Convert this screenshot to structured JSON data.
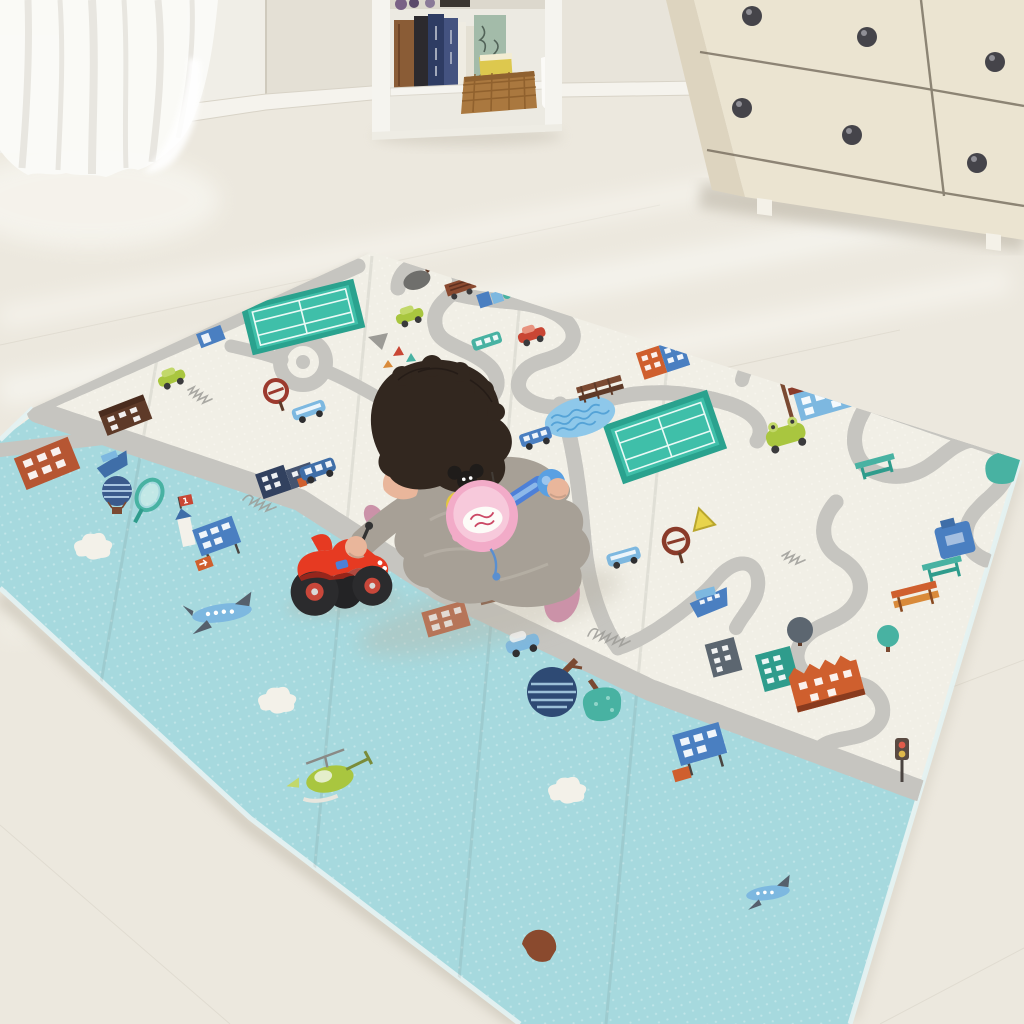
{
  "meta": {
    "description": "Lifestyle photo: baby in gray fleece onesie sits on a large foldable two-sided play mat (cream city-road side and light-blue sky side), playing with a red toy truck and a pink toy saucepan, in a bright nursery with sheer curtain, white bookshelf and cream dresser.",
    "setting": "nursery room, bright daylight"
  },
  "colors": {
    "wall": "#e8e4da",
    "wallBright": "#f0eee7",
    "wallDark": "#e4e0d5",
    "baseboard": "#f5f3ed",
    "floor": "#ece8de",
    "floorLight": "#fbfaf5",
    "shadow": "#b7b0a1",
    "curtain": "#fafaf7",
    "curtainFold": "#e4e2db",
    "shelf": "#f5f4ef",
    "shelfInner": "#eceae2",
    "shelfShade": "#dcd8cd",
    "bookBrown": "#8a5c36",
    "bookDark": "#2c2a2e",
    "bookNavy": "#2e3c63",
    "bookNavy2": "#445380",
    "bookWhite": "#efece2",
    "boxGreen": "#a3bba9",
    "boxPrint": "#44544a",
    "basket": "#aa783f",
    "basketDark": "#8a5c2a",
    "basketItem": "#ddc84e",
    "dresser": "#ebe4d1",
    "dresserSide": "#ddd4bf",
    "dresserLine": "#6d6455",
    "knob": "#45444a",
    "knobHi": "#908f96",
    "matWhite": "#f1efe6",
    "matDot": "#faf8f1",
    "matBlue": "#a6d9de",
    "matBlueDot": "#c4e7ea",
    "matEdgeFace": "#e4f1f1",
    "road": "#c6c5c0",
    "roadDash": "#ffffff",
    "courtTeal": "#3fbfa9",
    "courtTealDark": "#2aa28e",
    "courtLine": "#eafaf6",
    "pond": "#8ec8ea",
    "pondWave": "#4f9fd6",
    "navy": "#32415f",
    "slate": "#5c6670",
    "brown": "#7b4a32",
    "darkBrown": "#5e3a28",
    "rust": "#b65633",
    "orange": "#d98a3a",
    "orangeDeep": "#cf5f2e",
    "teal": "#48b2a2",
    "tealDeep": "#2f9c8c",
    "blue": "#4a7fc1",
    "skyBlue": "#7db8e0",
    "steel": "#3f6ea8",
    "red": "#c94634",
    "yellow": "#e8d44c",
    "green": "#a9c63f",
    "grayIcon": "#9c9b96",
    "white": "#ffffff",
    "babyHair": "#32271f",
    "babySkin": "#e9b69b",
    "suit": "#a7a096",
    "suitLight": "#bdb7ac",
    "pants": "#918a80",
    "sock": "#cb92a8",
    "truckRed": "#e63a22",
    "truckDark": "#b22618",
    "wheel": "#2b2b2d",
    "hub": "#c8473a",
    "hubHi": "#d9d9d9",
    "panPink": "#f2abc8",
    "panPinkLight": "#f7c9db",
    "panLabel": "#fdfcf8",
    "panRed": "#cc4a66",
    "handleBlue": "#4d80d8",
    "handleBall": "#5aa0e2",
    "handleHi": "#9cc6ee"
  },
  "room": {
    "curtain": {
      "type": "sheer white curtain",
      "position": "top-left"
    },
    "bookshelf": {
      "type": "white open bookcase",
      "contents": [
        "brown book",
        "dark book",
        "navy books with white spine text",
        "white book",
        "green botanical box",
        "wicker basket with yellow book",
        "white lace pouch",
        "purple items on top shelf"
      ]
    },
    "dresser": {
      "type": "cream 6-drawer dresser",
      "visible_drawer_rows": 2,
      "visible_knobs": 6,
      "knob_style": "round dark charcoal"
    },
    "floor": "pale cream wood with diagonal sunlight streaks"
  },
  "mat": {
    "type": "foldable baby play mat, two printed sides visible",
    "white_side_theme": "city road map with gray roads, tennis courts, pond, houses, cars, trees, signs",
    "blue_side_theme": "light blue sky with clouds, airplanes, helicopter, balloon, trees, signboards",
    "tower_flag_text": "1",
    "items": [
      "tennis-court",
      "tennis-court-2",
      "wavy-pond",
      "roundabout",
      "boundary-road",
      "school-building",
      "orange-blue-building",
      "brown-bridge",
      "brown-bench",
      "frying-pan-icon",
      "grill-truck",
      "blue-boxes",
      "teal-bird",
      "green-car",
      "green-car-2",
      "parking-sign",
      "red-car",
      "teal-bus",
      "gray-triangle",
      "mini-cones",
      "wheel-sign",
      "wheel-sign-2",
      "yellow-warning-sign",
      "frog-car",
      "teal-picnic-table",
      "teal-picnic-table-2",
      "teal-tree",
      "red-car-2",
      "blue-jug-truck",
      "orange-bench",
      "gray-tree",
      "navy-building-row",
      "navy-building",
      "teal-building",
      "orange-castle-building",
      "traffic-light",
      "blue-taxi",
      "blue-bus",
      "white-blue-bus",
      "bus-on-road",
      "brown-house",
      "orange-building-2",
      "blue-bus-3",
      "blue-ferry",
      "brown-building-left",
      "handwriting-squiggles",
      "orange-building-blue-side",
      "blue-boat",
      "striped-hot-air-balloon",
      "tennis-racket",
      "tower-with-flag-1",
      "blue-signboard-left",
      "big-airplane",
      "clouds",
      "striped-tree",
      "teal-round-tree",
      "blue-signboard-right",
      "small-airplane",
      "half-brown-circle",
      "green-helicopter",
      "blue-car-4"
    ]
  },
  "baby": {
    "hair": "dark brown, tousled",
    "outfit": "light gray fleece hooded onesie with cartoon mouse-and-yellow-face chest graphic",
    "socks": "dusty pink",
    "pose": "sitting, right hand on red toy truck, left hand holding blue handle of pink toy pan"
  },
  "toys": [
    {
      "name": "red ride-on toy truck",
      "details": "black wheels with red hubs, blue decal"
    },
    {
      "name": "pink toy saucepan",
      "details": "white label, blue handle with light-blue ball end"
    }
  ]
}
